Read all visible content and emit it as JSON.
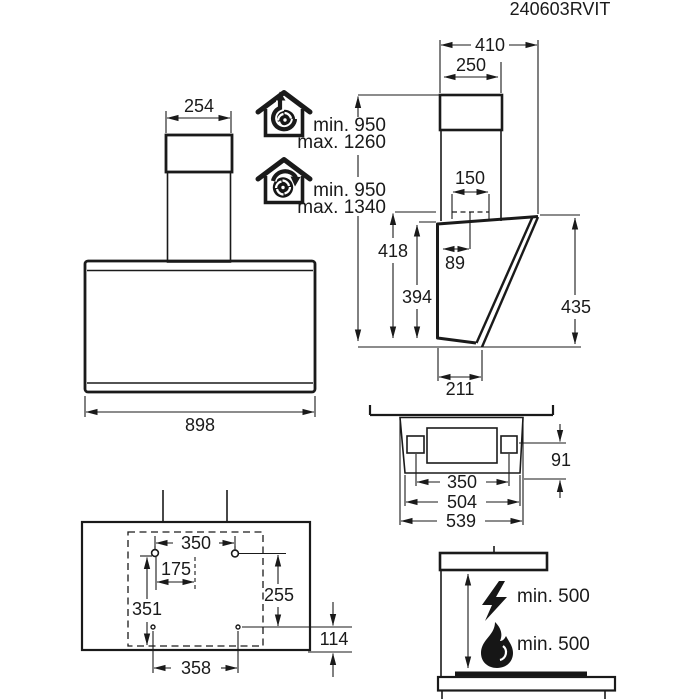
{
  "title": "240603RVIT",
  "colors": {
    "ink": "#1a1a1a",
    "background": "#ffffff"
  },
  "front_view": {
    "chimney_width": "254",
    "body_width": "898"
  },
  "installation": {
    "ducted": {
      "line1": "min. 950",
      "line2": "max. 1260"
    },
    "recirculating": {
      "line1": "min. 950",
      "line2": "max. 1340"
    }
  },
  "side_view": {
    "total_depth": "410",
    "chimney_depth": "250",
    "duct_width": "150",
    "duct_offset": "89",
    "height_with_duct": "418",
    "body_rear_height": "394",
    "front_height": "435",
    "bottom_depth": "211"
  },
  "plan_view": {
    "fixing_width": "350",
    "body_depth": "504",
    "overall_depth": "539",
    "fixing_offset": "91"
  },
  "wall_template": {
    "upper_hole_spacing": "350",
    "half_spacing": "175",
    "vertical_spacing": "351",
    "right_vertical": "255",
    "bottom_offset": "114",
    "lower_hole_spacing": "358"
  },
  "clearances": {
    "electric_hob": "min. 500",
    "gas_hob": "min. 500"
  },
  "icons": {
    "ducted": "house-exhaust-fan-icon",
    "recirculating": "house-recirculation-fan-icon",
    "electric": "lightning-bolt-icon",
    "gas": "flame-icon"
  }
}
